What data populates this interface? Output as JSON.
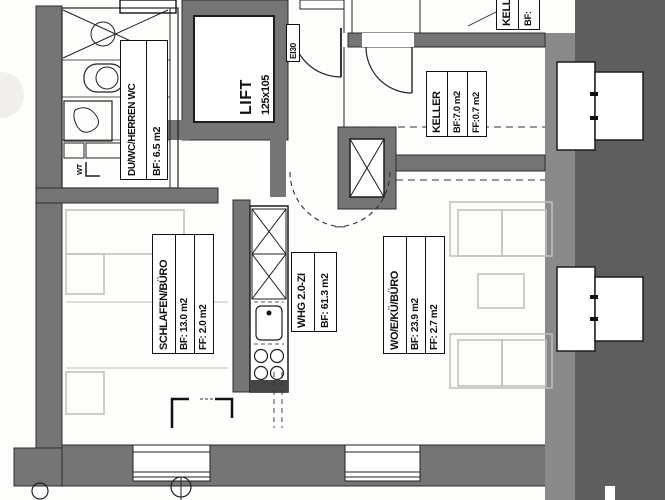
{
  "plan": {
    "rooms": {
      "bathroom": {
        "name": "DU/WC/HERREN WC",
        "area": "BF: 6.5 m2"
      },
      "lift": {
        "name": "LIFT",
        "dimensions": "125x105"
      },
      "keller": {
        "name": "KELLER",
        "area": "BF:7.0 m2",
        "floor_area": "FF:0.7 m2"
      },
      "keller_partial": {
        "name": "KELL",
        "area": "BF:"
      },
      "bedroom": {
        "name": "SCHLAFEN/BÜRO",
        "area": "BF: 13.0 m2",
        "floor_area": "FF: 2.0 m2"
      },
      "apartment": {
        "name": "WHG 2.0-ZI",
        "area": "BF: 61.3 m2"
      },
      "living": {
        "name": "WO/E/KÜ/BÜRO",
        "area": "BF: 23.9 m2",
        "floor_area": "FF: 2.7 m2"
      }
    },
    "annotations": {
      "fire_door": "EI30",
      "washbasin": "WT"
    },
    "colors": {
      "wall": "#757575",
      "wall_dark": "#5e5e5e",
      "wall_mid": "#8a8a8a",
      "line": "#1d1d1d",
      "furniture": "#c1bfbc",
      "paper": "#ffffff"
    }
  }
}
